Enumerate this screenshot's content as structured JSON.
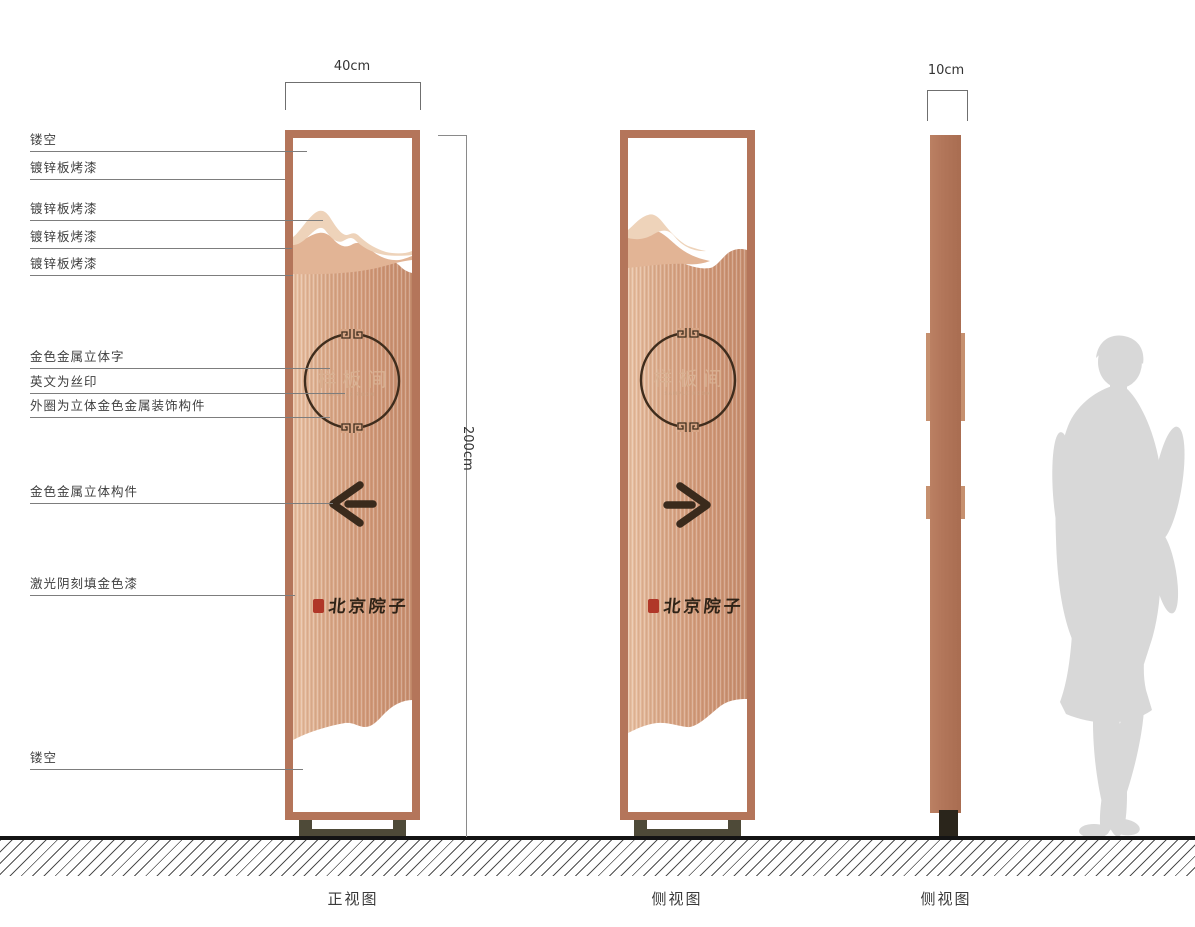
{
  "page": {
    "background": "#ffffff"
  },
  "colors": {
    "frame_copper": "#b4755a",
    "panel_gradient_left": "#e8c0a2",
    "panel_gradient_right": "#c68e6f",
    "mountain_light": "#eed3ba",
    "mountain_mid": "#e2b495",
    "arrow_dark": "#3a2a1c",
    "circle_stroke": "#3f2d1d",
    "gold_text": "#d9b192",
    "seal_red": "#b03728",
    "base_olive": "#4e4a38",
    "ground_black": "#141414",
    "silhouette_grey": "#d8d8d8"
  },
  "dimensions": {
    "front_width": "40cm",
    "sign_height": "200cm",
    "side_width": "10cm"
  },
  "callouts": [
    {
      "label": "镂空"
    },
    {
      "label": "镀锌板烤漆"
    },
    {
      "label": "镀锌板烤漆"
    },
    {
      "label": "镀锌板烤漆"
    },
    {
      "label": "镀锌板烤漆"
    },
    {
      "label": "金色金属立体字"
    },
    {
      "label": "英文为丝印"
    },
    {
      "label": "外圈为立体金色金属装饰构件"
    },
    {
      "label": "金色金属立体构件"
    },
    {
      "label": "激光阴刻填金色漆"
    },
    {
      "label": "镂空"
    }
  ],
  "sign_content": {
    "room_name": "样板间",
    "room_name_en": "SAMPLE ROOM",
    "brand_name": "北京院子"
  },
  "view_labels": {
    "front": "正视图",
    "side1": "侧视图",
    "side2": "侧视图"
  }
}
